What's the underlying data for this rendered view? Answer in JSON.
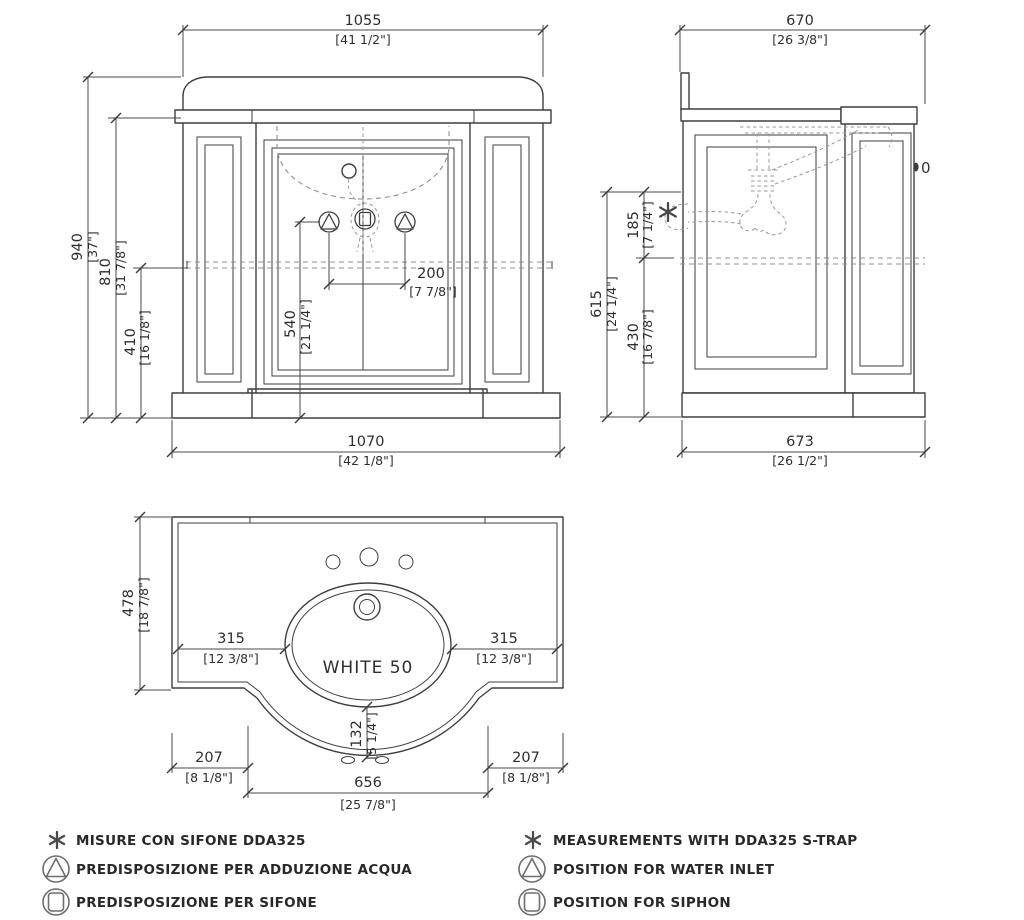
{
  "drawing_title": "WHITE 50 vanity technical drawing",
  "front_view": {
    "dim_top_width": {
      "mm": "1055",
      "in": "[41 1/2\"]"
    },
    "dim_total_height": {
      "mm": "940",
      "in": "[37\"]"
    },
    "dim_counter_height": {
      "mm": "810",
      "in": "[31 7/8\"]"
    },
    "dim_wall_height": {
      "mm": "410",
      "in": "[16 1/8\"]"
    },
    "dim_inlet_height": {
      "mm": "540",
      "in": "[21 1/4\"]"
    },
    "dim_inlet_spacing": {
      "mm": "200",
      "in": "[7 7/8\"]"
    },
    "dim_base_width": {
      "mm": "1070",
      "in": "[42 1/8\"]"
    }
  },
  "side_view": {
    "dim_top_depth": {
      "mm": "670",
      "in": "[26 3/8\"]"
    },
    "dim_trap_height": {
      "mm": "615",
      "in": "[24 1/4\"]"
    },
    "dim_trap_offset": {
      "mm": "185",
      "in": "[7 1/4\"]"
    },
    "dim_wall_height": {
      "mm": "430",
      "in": "[16 7/8\"]"
    },
    "dim_base_depth": {
      "mm": "673",
      "in": "[26 1/2\"]"
    },
    "knob_text": "0"
  },
  "top_view": {
    "product_label": "WHITE 50",
    "dim_depth": {
      "mm": "478",
      "in": "[18 7/8\"]"
    },
    "dim_left_offset": {
      "mm": "315",
      "in": "[12 3/8\"]"
    },
    "dim_right_offset": {
      "mm": "315",
      "in": "[12 3/8\"]"
    },
    "dim_front_offset": {
      "mm": "132",
      "in": "[5 1/4\"]"
    },
    "dim_left_margin": {
      "mm": "207",
      "in": "[8 1/8\"]"
    },
    "dim_basin_width": {
      "mm": "656",
      "in": "[25 7/8\"]"
    },
    "dim_right_margin": {
      "mm": "207",
      "in": "[8 1/8\"]"
    }
  },
  "legend": {
    "italian": [
      {
        "symbol": "asterisk-icon",
        "text": "MISURE CON SIFONE DDA325"
      },
      {
        "symbol": "water-inlet-icon",
        "text": "PREDISPOSIZIONE PER ADDUZIONE ACQUA"
      },
      {
        "symbol": "siphon-icon",
        "text": "PREDISPOSIZIONE PER SIFONE"
      }
    ],
    "english": [
      {
        "symbol": "asterisk-icon",
        "text": "MEASUREMENTS WITH  DDA325  S-TRAP"
      },
      {
        "symbol": "water-inlet-icon",
        "text": "POSITION FOR WATER INLET"
      },
      {
        "symbol": "siphon-icon",
        "text": "POSITION FOR SIPHON"
      }
    ]
  },
  "colors": {
    "line": "#3e3e3e",
    "dimension": "#4a4a4a",
    "dashed": "#8f8f8f",
    "text": "#2e2e2e",
    "background": "#ffffff"
  }
}
